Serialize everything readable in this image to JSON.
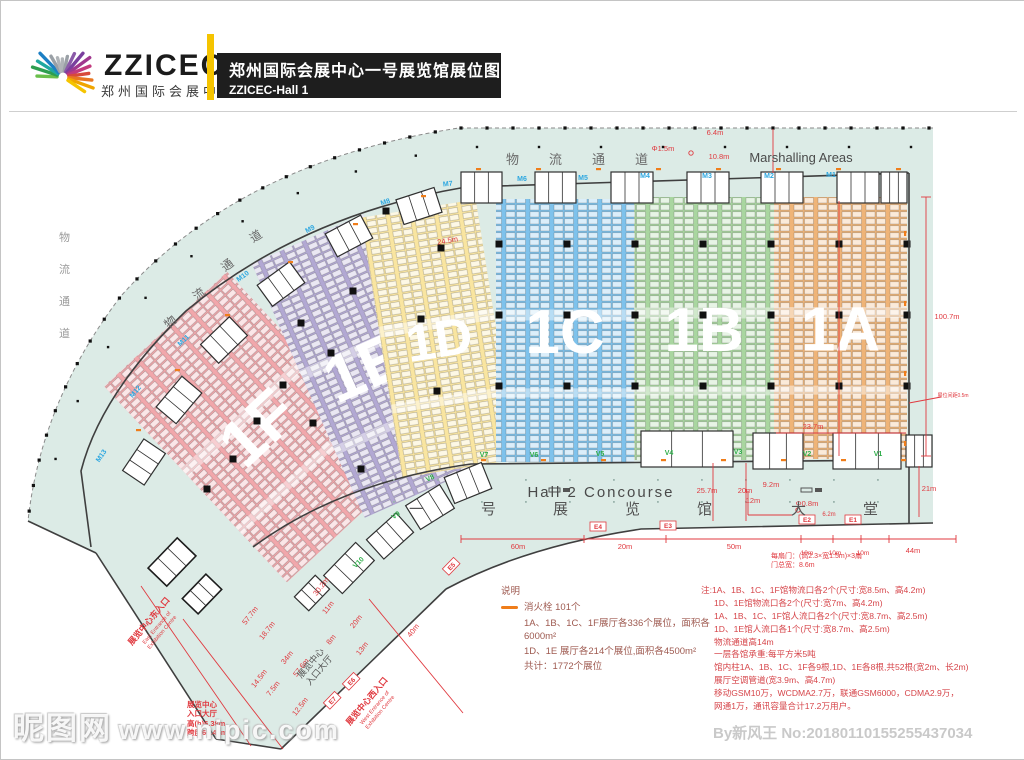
{
  "header": {
    "logo_title": "ZZICEC",
    "logo_subtitle": "郑州国际会展中心",
    "title": "郑州国际会展中心一号展览馆展位图",
    "subtitle": "ZZICEC-Hall 1"
  },
  "plan": {
    "marshalling_label": "Marshalling Areas",
    "logistics_corridor_top": [
      "物",
      "流",
      "通",
      "道"
    ],
    "logistics_corridor_arc": [
      "物",
      "流",
      "通",
      "道"
    ],
    "logistics_corridor_left": [
      "物",
      "流",
      "通",
      "道"
    ],
    "concourse_label": "Hall 2 Concourse",
    "lobby_label": [
      "一",
      "号",
      "展",
      "览",
      "馆",
      "大",
      "堂"
    ],
    "zones": [
      {
        "id": "1F",
        "label": "1F",
        "color": "#f1a7ab",
        "x": 172,
        "y": 292,
        "w": 168,
        "h": 268,
        "rot": -43,
        "fs": 66
      },
      {
        "id": "1E",
        "label": "1E",
        "color": "#b2a8d3",
        "x": 302,
        "y": 226,
        "w": 122,
        "h": 278,
        "rot": -24,
        "fs": 66
      },
      {
        "id": "1D",
        "label": "1D",
        "color": "#f9e5a0",
        "x": 380,
        "y": 206,
        "w": 116,
        "h": 263,
        "rot": -9,
        "fs": 52
      },
      {
        "id": "1C",
        "label": "1C",
        "color": "#7ec2ec",
        "x": 495,
        "y": 198,
        "w": 138,
        "h": 263,
        "rot": 0,
        "fs": 62
      },
      {
        "id": "1B",
        "label": "1B",
        "color": "#a9d6a0",
        "x": 633,
        "y": 196,
        "w": 140,
        "h": 263,
        "rot": 0,
        "fs": 62
      },
      {
        "id": "1A",
        "label": "1A",
        "color": "#efb478",
        "x": 773,
        "y": 196,
        "w": 133,
        "h": 262,
        "rot": 0,
        "fs": 62
      }
    ],
    "m_gates": [
      {
        "label": "M1",
        "x": 830,
        "y": 176,
        "rot": 0
      },
      {
        "label": "M2",
        "x": 768,
        "y": 177,
        "rot": 0
      },
      {
        "label": "M3",
        "x": 706,
        "y": 177,
        "rot": 0
      },
      {
        "label": "M4",
        "x": 644,
        "y": 177,
        "rot": 0
      },
      {
        "label": "M5",
        "x": 582,
        "y": 179,
        "rot": 0
      },
      {
        "label": "M6",
        "x": 521,
        "y": 180,
        "rot": 0
      },
      {
        "label": "M7",
        "x": 447,
        "y": 185,
        "rot": -6
      },
      {
        "label": "M8",
        "x": 385,
        "y": 203,
        "rot": -18
      },
      {
        "label": "M9",
        "x": 310,
        "y": 230,
        "rot": -28
      },
      {
        "label": "M10",
        "x": 243,
        "y": 277,
        "rot": -36
      },
      {
        "label": "M11",
        "x": 184,
        "y": 341,
        "rot": -44
      },
      {
        "label": "M12",
        "x": 136,
        "y": 392,
        "rot": -50
      },
      {
        "label": "M13",
        "x": 102,
        "y": 456,
        "rot": -56
      }
    ],
    "v_gates": [
      {
        "label": "V1",
        "x": 877,
        "y": 455,
        "rot": 0
      },
      {
        "label": "V2",
        "x": 806,
        "y": 455,
        "rot": 0
      },
      {
        "label": "V3",
        "x": 737,
        "y": 453,
        "rot": 0
      },
      {
        "label": "V4",
        "x": 668,
        "y": 454,
        "rot": 0
      },
      {
        "label": "V5",
        "x": 599,
        "y": 455,
        "rot": 0
      },
      {
        "label": "V6",
        "x": 533,
        "y": 456,
        "rot": 0
      },
      {
        "label": "V7",
        "x": 483,
        "y": 456,
        "rot": 0
      },
      {
        "label": "V8",
        "x": 430,
        "y": 479,
        "rot": -26
      },
      {
        "label": "V9",
        "x": 396,
        "y": 516,
        "rot": -36
      },
      {
        "label": "V10",
        "x": 359,
        "y": 563,
        "rot": -46
      }
    ],
    "e_gates": [
      {
        "label": "E1",
        "x": 852,
        "y": 521,
        "rot": 0
      },
      {
        "label": "E2",
        "x": 806,
        "y": 521,
        "rot": 0
      },
      {
        "label": "E3",
        "x": 667,
        "y": 527,
        "rot": 0
      },
      {
        "label": "E4",
        "x": 597,
        "y": 528,
        "rot": 0
      },
      {
        "label": "E5",
        "x": 452,
        "y": 567,
        "rot": -46
      },
      {
        "label": "E6",
        "x": 352,
        "y": 682,
        "rot": -46
      },
      {
        "label": "E7",
        "x": 333,
        "y": 701,
        "rot": -46
      }
    ],
    "dimensions": [
      {
        "label": "6.4m",
        "x": 714,
        "y": 134,
        "rot": 0
      },
      {
        "label": "Φ1.5m",
        "x": 662,
        "y": 150,
        "rot": 0
      },
      {
        "label": "10.8m",
        "x": 718,
        "y": 158,
        "rot": 0
      },
      {
        "label": "100.7m",
        "x": 946,
        "y": 318,
        "rot": 0
      },
      {
        "label": "展位间距0.5m",
        "x": 952,
        "y": 396,
        "rot": 0,
        "fs": 5
      },
      {
        "label": "21m",
        "x": 928,
        "y": 490,
        "rot": 0
      },
      {
        "label": "9.2m",
        "x": 770,
        "y": 486,
        "rot": 0
      },
      {
        "label": "12m",
        "x": 752,
        "y": 502,
        "rot": 0
      },
      {
        "label": "Φ0.8m",
        "x": 806,
        "y": 505,
        "rot": 0
      },
      {
        "label": "25.7m",
        "x": 706,
        "y": 492,
        "rot": 0
      },
      {
        "label": "20m",
        "x": 744,
        "y": 492,
        "rot": 0
      },
      {
        "label": "60m",
        "x": 517,
        "y": 548,
        "rot": 0
      },
      {
        "label": "20m",
        "x": 624,
        "y": 548,
        "rot": 0
      },
      {
        "label": "50m",
        "x": 733,
        "y": 548,
        "rot": 0
      },
      {
        "label": "6.2m",
        "x": 828,
        "y": 515,
        "rot": 0,
        "fs": 6
      },
      {
        "label": "10m",
        "x": 806,
        "y": 554,
        "rot": 0,
        "fs": 6.5
      },
      {
        "label": "10m",
        "x": 834,
        "y": 554,
        "rot": 0,
        "fs": 6.5
      },
      {
        "label": "10m",
        "x": 862,
        "y": 554,
        "rot": 0,
        "fs": 6.5
      },
      {
        "label": "44m",
        "x": 912,
        "y": 552,
        "rot": 0
      },
      {
        "label": "24.5m",
        "x": 447,
        "y": 242,
        "rot": -10
      },
      {
        "label": "23.7m",
        "x": 812,
        "y": 428,
        "rot": 0
      },
      {
        "label": "57.7m",
        "x": 251,
        "y": 616,
        "rot": -52
      },
      {
        "label": "18.7m",
        "x": 268,
        "y": 631,
        "rot": -52
      },
      {
        "label": "34m",
        "x": 288,
        "y": 658,
        "rot": -52
      },
      {
        "label": "57.6m",
        "x": 302,
        "y": 668,
        "rot": -52
      },
      {
        "label": "14.5m",
        "x": 260,
        "y": 679,
        "rot": -52
      },
      {
        "label": "7.5m",
        "x": 274,
        "y": 689,
        "rot": -52
      },
      {
        "label": "12.5m",
        "x": 301,
        "y": 707,
        "rot": -52
      },
      {
        "label": "30.2m",
        "x": 322,
        "y": 587,
        "rot": -52
      },
      {
        "label": "11m",
        "x": 329,
        "y": 608,
        "rot": -52
      },
      {
        "label": "20m",
        "x": 357,
        "y": 622,
        "rot": -52
      },
      {
        "label": "8m",
        "x": 332,
        "y": 640,
        "rot": -52
      },
      {
        "label": "13m",
        "x": 363,
        "y": 649,
        "rot": -52
      },
      {
        "label": "40m",
        "x": 414,
        "y": 631,
        "rot": -52
      }
    ],
    "entrance_east": {
      "zh": "展览中心东入口",
      "en1": "East Entrance of",
      "en2": "Exhibition Centre"
    },
    "entrance_west": {
      "zh": "展览中心西入口",
      "en1": "West Entrance of",
      "en2": "Exhibition Centre"
    },
    "entrance_hall": [
      "展览中心",
      "入口大厅"
    ],
    "entrance_note": [
      "展览中心",
      "入口大厅",
      "高(h)6.38m",
      "跨度60.45m"
    ],
    "door_note": [
      "每扇门：(高2.3×宽1.5m)×3扇",
      "门总宽：8.6m"
    ]
  },
  "legend": {
    "title": "说明",
    "hydrant_item": "消火栓 101个",
    "items": [
      "1A、1B、1C、1F展厅各336个展位，面积各6000m²",
      "1D、1E 展厅各214个展位,面积各4500m²",
      "共计：1772个展位"
    ]
  },
  "notes": {
    "lines": [
      "注:1A、1B、1C、1F馆物流口各2个(尺寸:宽8.5m、高4.2m)",
      "1D、1E馆物流口各2个(尺寸:宽7m、高4.2m)",
      "1A、1B、1C、1F馆人流口各2个(尺寸:宽8.7m、高2.5m)",
      "1D、1E馆人流口各1个(尺寸:宽8.7m、高2.5m)",
      "物流通道高14m",
      "一层各馆承重:每平方米5吨",
      "馆内柱1A、1B、1C、1F各9根,1D、1E各8根,共52根(宽2m、长2m)",
      "展厅空调管道(宽3.9m、高4.7m)",
      "移动GSM10万，WCDMA2.7万，联通GSM6000，CDMA2.9万，",
      "网通1万，通讯容量合计17.2万用户。"
    ]
  },
  "watermarks": {
    "site": "昵图网",
    "site_url": "www.nipic.com",
    "id_text": "By新风王 No:20180110155255437034"
  },
  "colors": {
    "floor": "#dcebe6",
    "wall": "#3f3f3f",
    "accent_red": "#e0393f",
    "gate_blue": "#2da7e0",
    "gate_green": "#2fae4a",
    "header_yellow": "#f5c400",
    "hydrant_orange": "#ef7d1a"
  }
}
